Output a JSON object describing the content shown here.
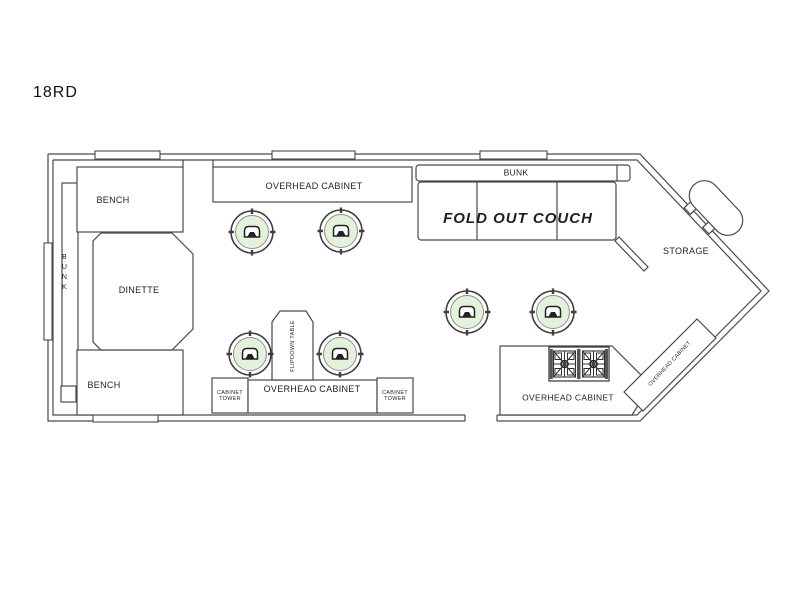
{
  "labels": {
    "title": "18RD",
    "bench_top": "BENCH",
    "bunk_left": "BUNK",
    "dinette": "DINETTE",
    "bench_bottom": "BENCH",
    "overhead_cabinet_top": "OVERHEAD CABINET",
    "bunk_top": "BUNK",
    "fold_out_couch": "FOLD OUT COUCH",
    "storage": "STORAGE",
    "cabinet_tower_left": "CABINET TOWER",
    "overhead_cabinet_mid": "OVERHEAD CABINET",
    "cabinet_tower_right": "CABINET TOWER",
    "flipdown_table": "FLIPDOWN TABLE",
    "overhead_cabinet_kitchen": "OVERHEAD CABINET",
    "overhead_cabinet_angled": "OVERHEAD CABINET"
  },
  "fixtures": {
    "stool_count": 6,
    "stove": "two-burner-cooktop",
    "tank": "propane-tank"
  },
  "colors": {
    "line": "#4a4a4a",
    "stool_fill": "#e4f2dc",
    "text": "#1f1f1f"
  }
}
